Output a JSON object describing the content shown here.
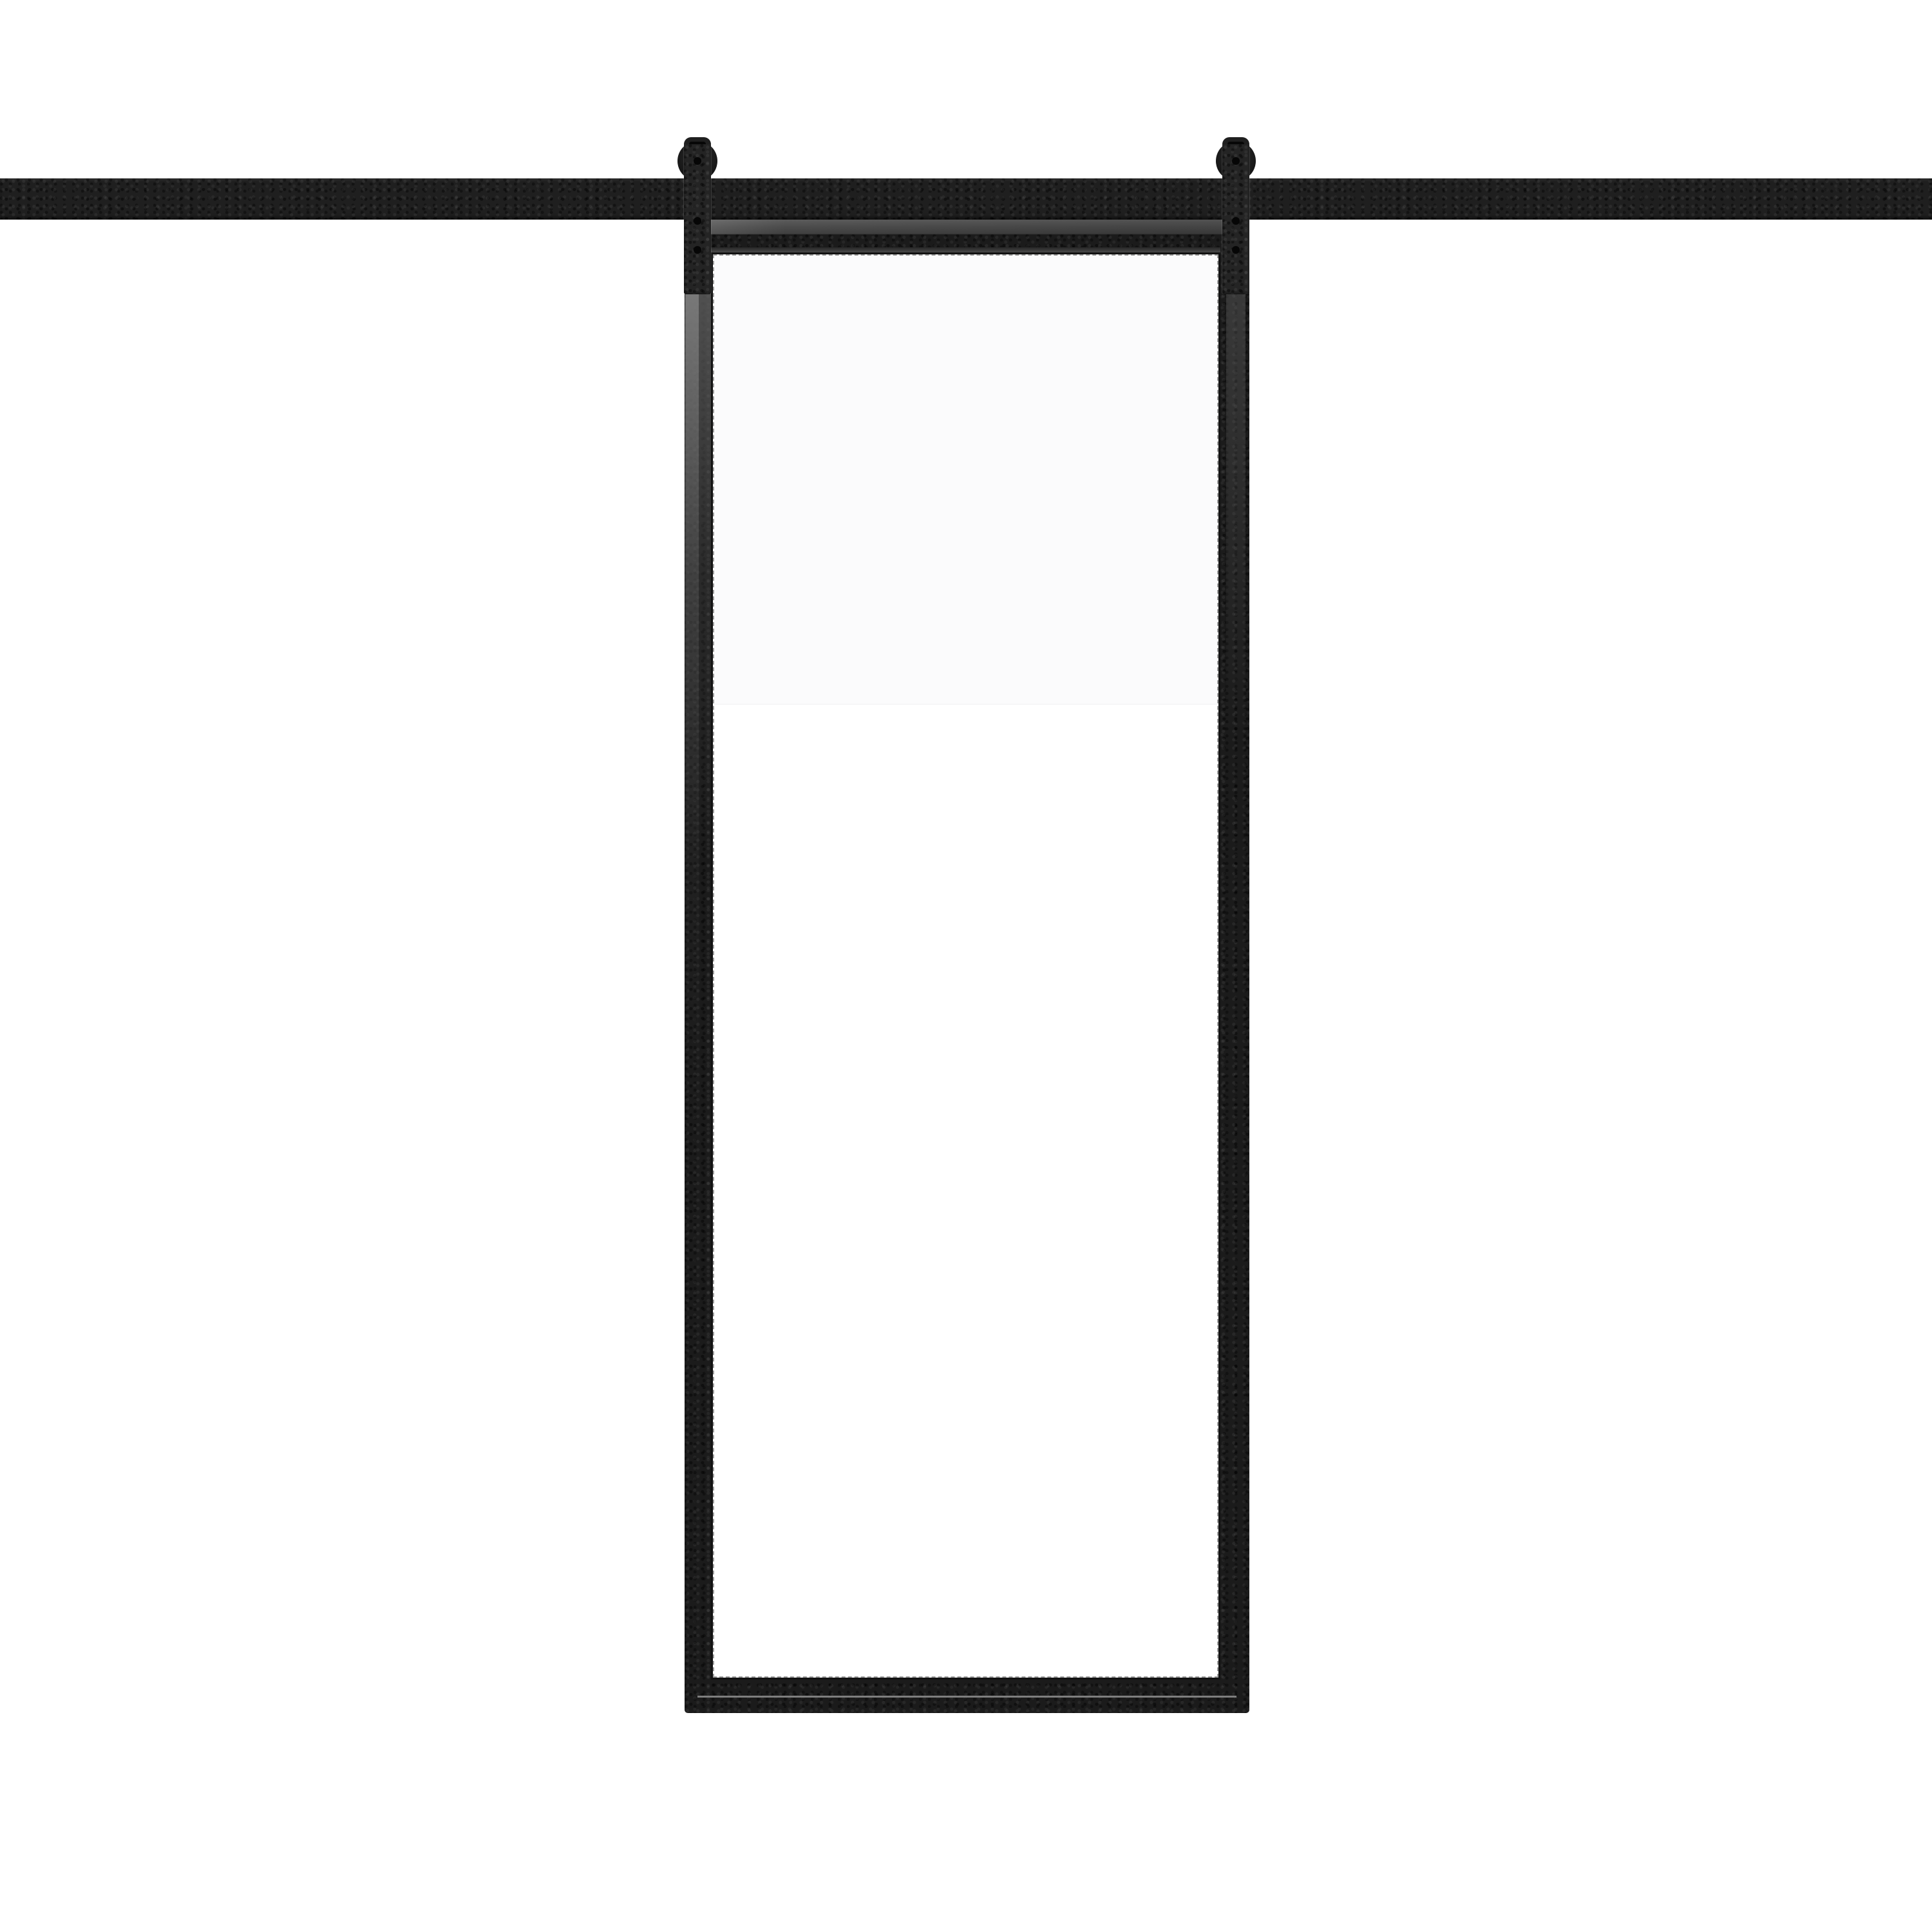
{
  "scene": {
    "type": "product-image",
    "subject": "Sliding barn door with black steel frame and clear glass panel hanging from a top-mount flat track rail by two roller hangers",
    "background": "#ffffff"
  },
  "colors": {
    "bg": "#ffffff",
    "rail": "#1f1f1f",
    "strap": "#242424",
    "hardwareDark": "#060606",
    "frame": "#1b1b1b",
    "frameBevel": "#4e4e4e",
    "capLight": "#606060",
    "capDark": "#3c3c3c",
    "glass": "#ffffff",
    "glassTint": "#fbfbfc",
    "glassEdge": "#9e9e9e",
    "seamLight": "#8f8f8f"
  },
  "components": {
    "rail": {
      "label": "Flat track rail",
      "spans_full_width": true
    },
    "hangers": {
      "count": 2,
      "left_label": "Left roller hanger",
      "right_label": "Right roller hanger",
      "bolts_per_strap": 2
    },
    "door": {
      "label": "Glass barn door",
      "glass_label": "Clear glass panel",
      "lite_count": 1
    }
  }
}
